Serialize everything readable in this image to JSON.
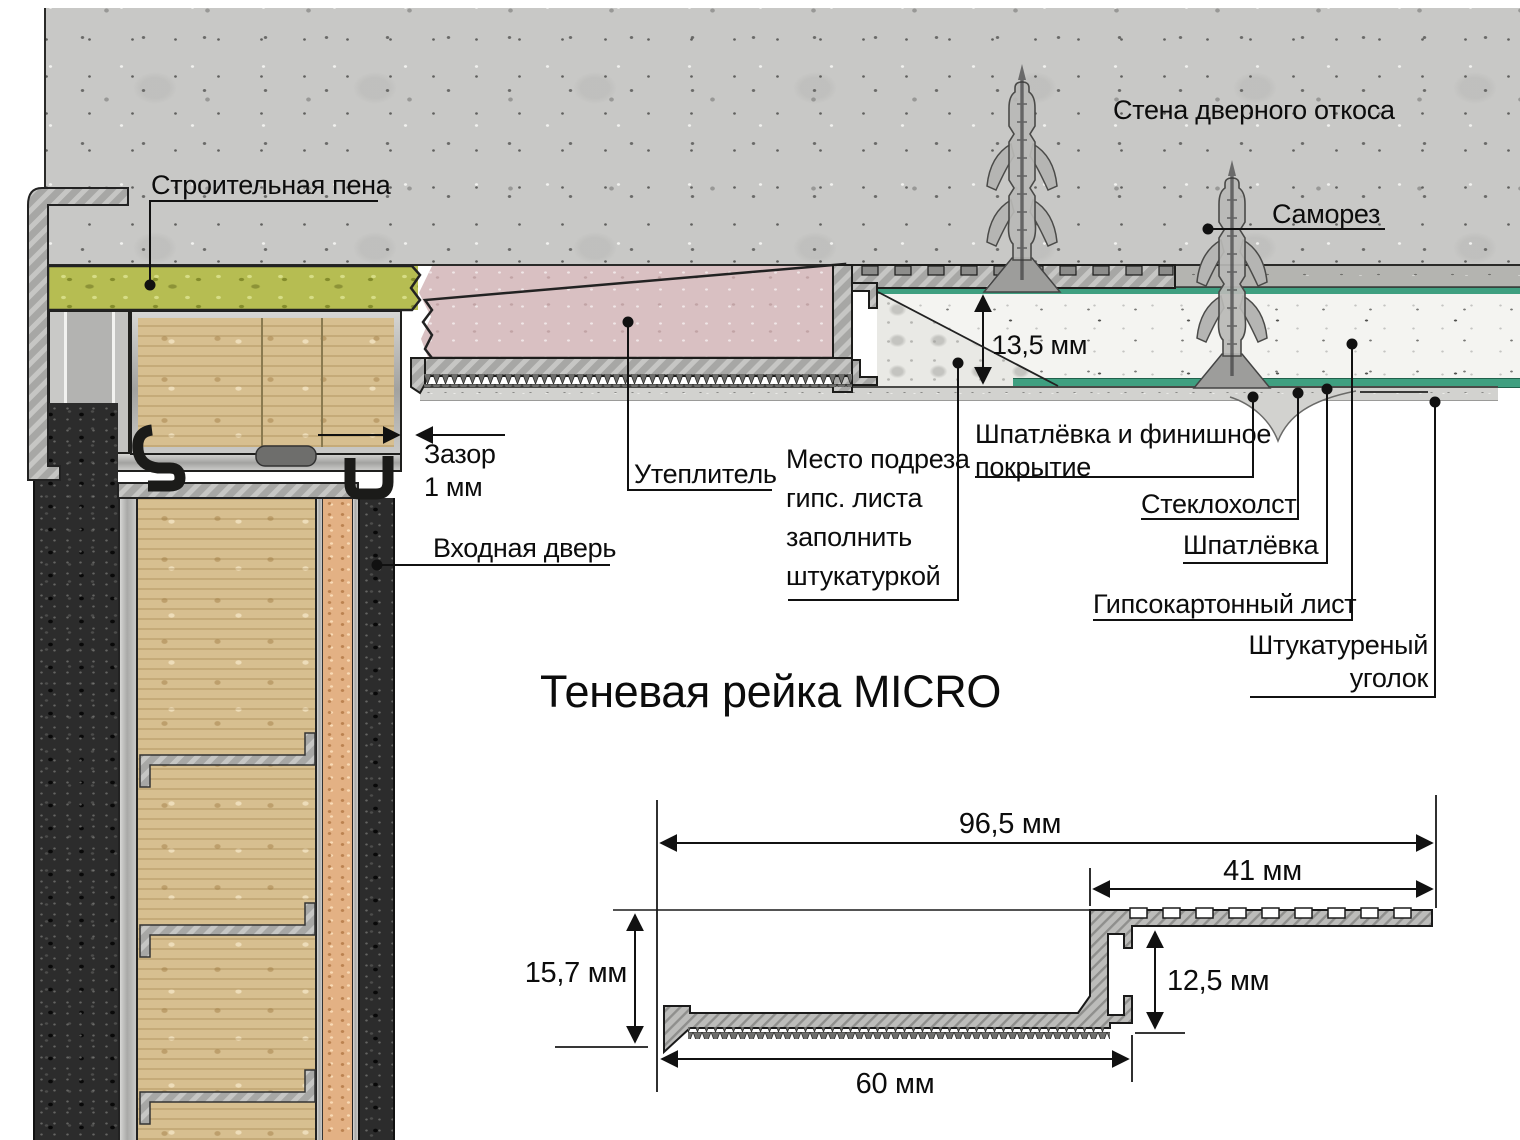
{
  "installation_diagram": {
    "labels": {
      "wall_slope": "Стена дверного откоса",
      "screw": "Саморез",
      "construction_foam": "Строительная пена",
      "gap": "Зазор\n1 мм",
      "entry_door": "Входная дверь",
      "insulation": "Утеплитель",
      "gypsum_cut_note": "Место подреза\nгипс. листа\nзаполнить\nштукатуркой",
      "putty_and_finish": "Шпатлёвка и финишное\nпокрытие",
      "fiberglass_mesh": "Стеклохолст",
      "putty": "Шпатлёвка",
      "drywall_sheet": "Гипсокартонный лист",
      "plastered_corner": "Штукатуреный\nуголок",
      "recess_depth": "13,5 мм"
    }
  },
  "profile_drawing": {
    "title": "Теневая рейка MICRO",
    "dimensions": {
      "overall_width": "96,5 мм",
      "top_flange_width": "41 мм",
      "profile_height": "15,7 мм",
      "channel_height": "12,5 мм",
      "bottom_flange_width": "60 мм"
    }
  },
  "colors": {
    "concrete": "#c8c8c6",
    "construction_foam": "#b6bd52",
    "insulation_pink": "#d9c0c2",
    "mineral_wool": "#d7bf90",
    "fiberglass_green": "#3f9f80",
    "metal": "#a7a7a5",
    "drywall": "#f4f4f1",
    "putty": "#d2d2cf",
    "cork": "#e3b184",
    "door_black": "#2c2c2c"
  }
}
